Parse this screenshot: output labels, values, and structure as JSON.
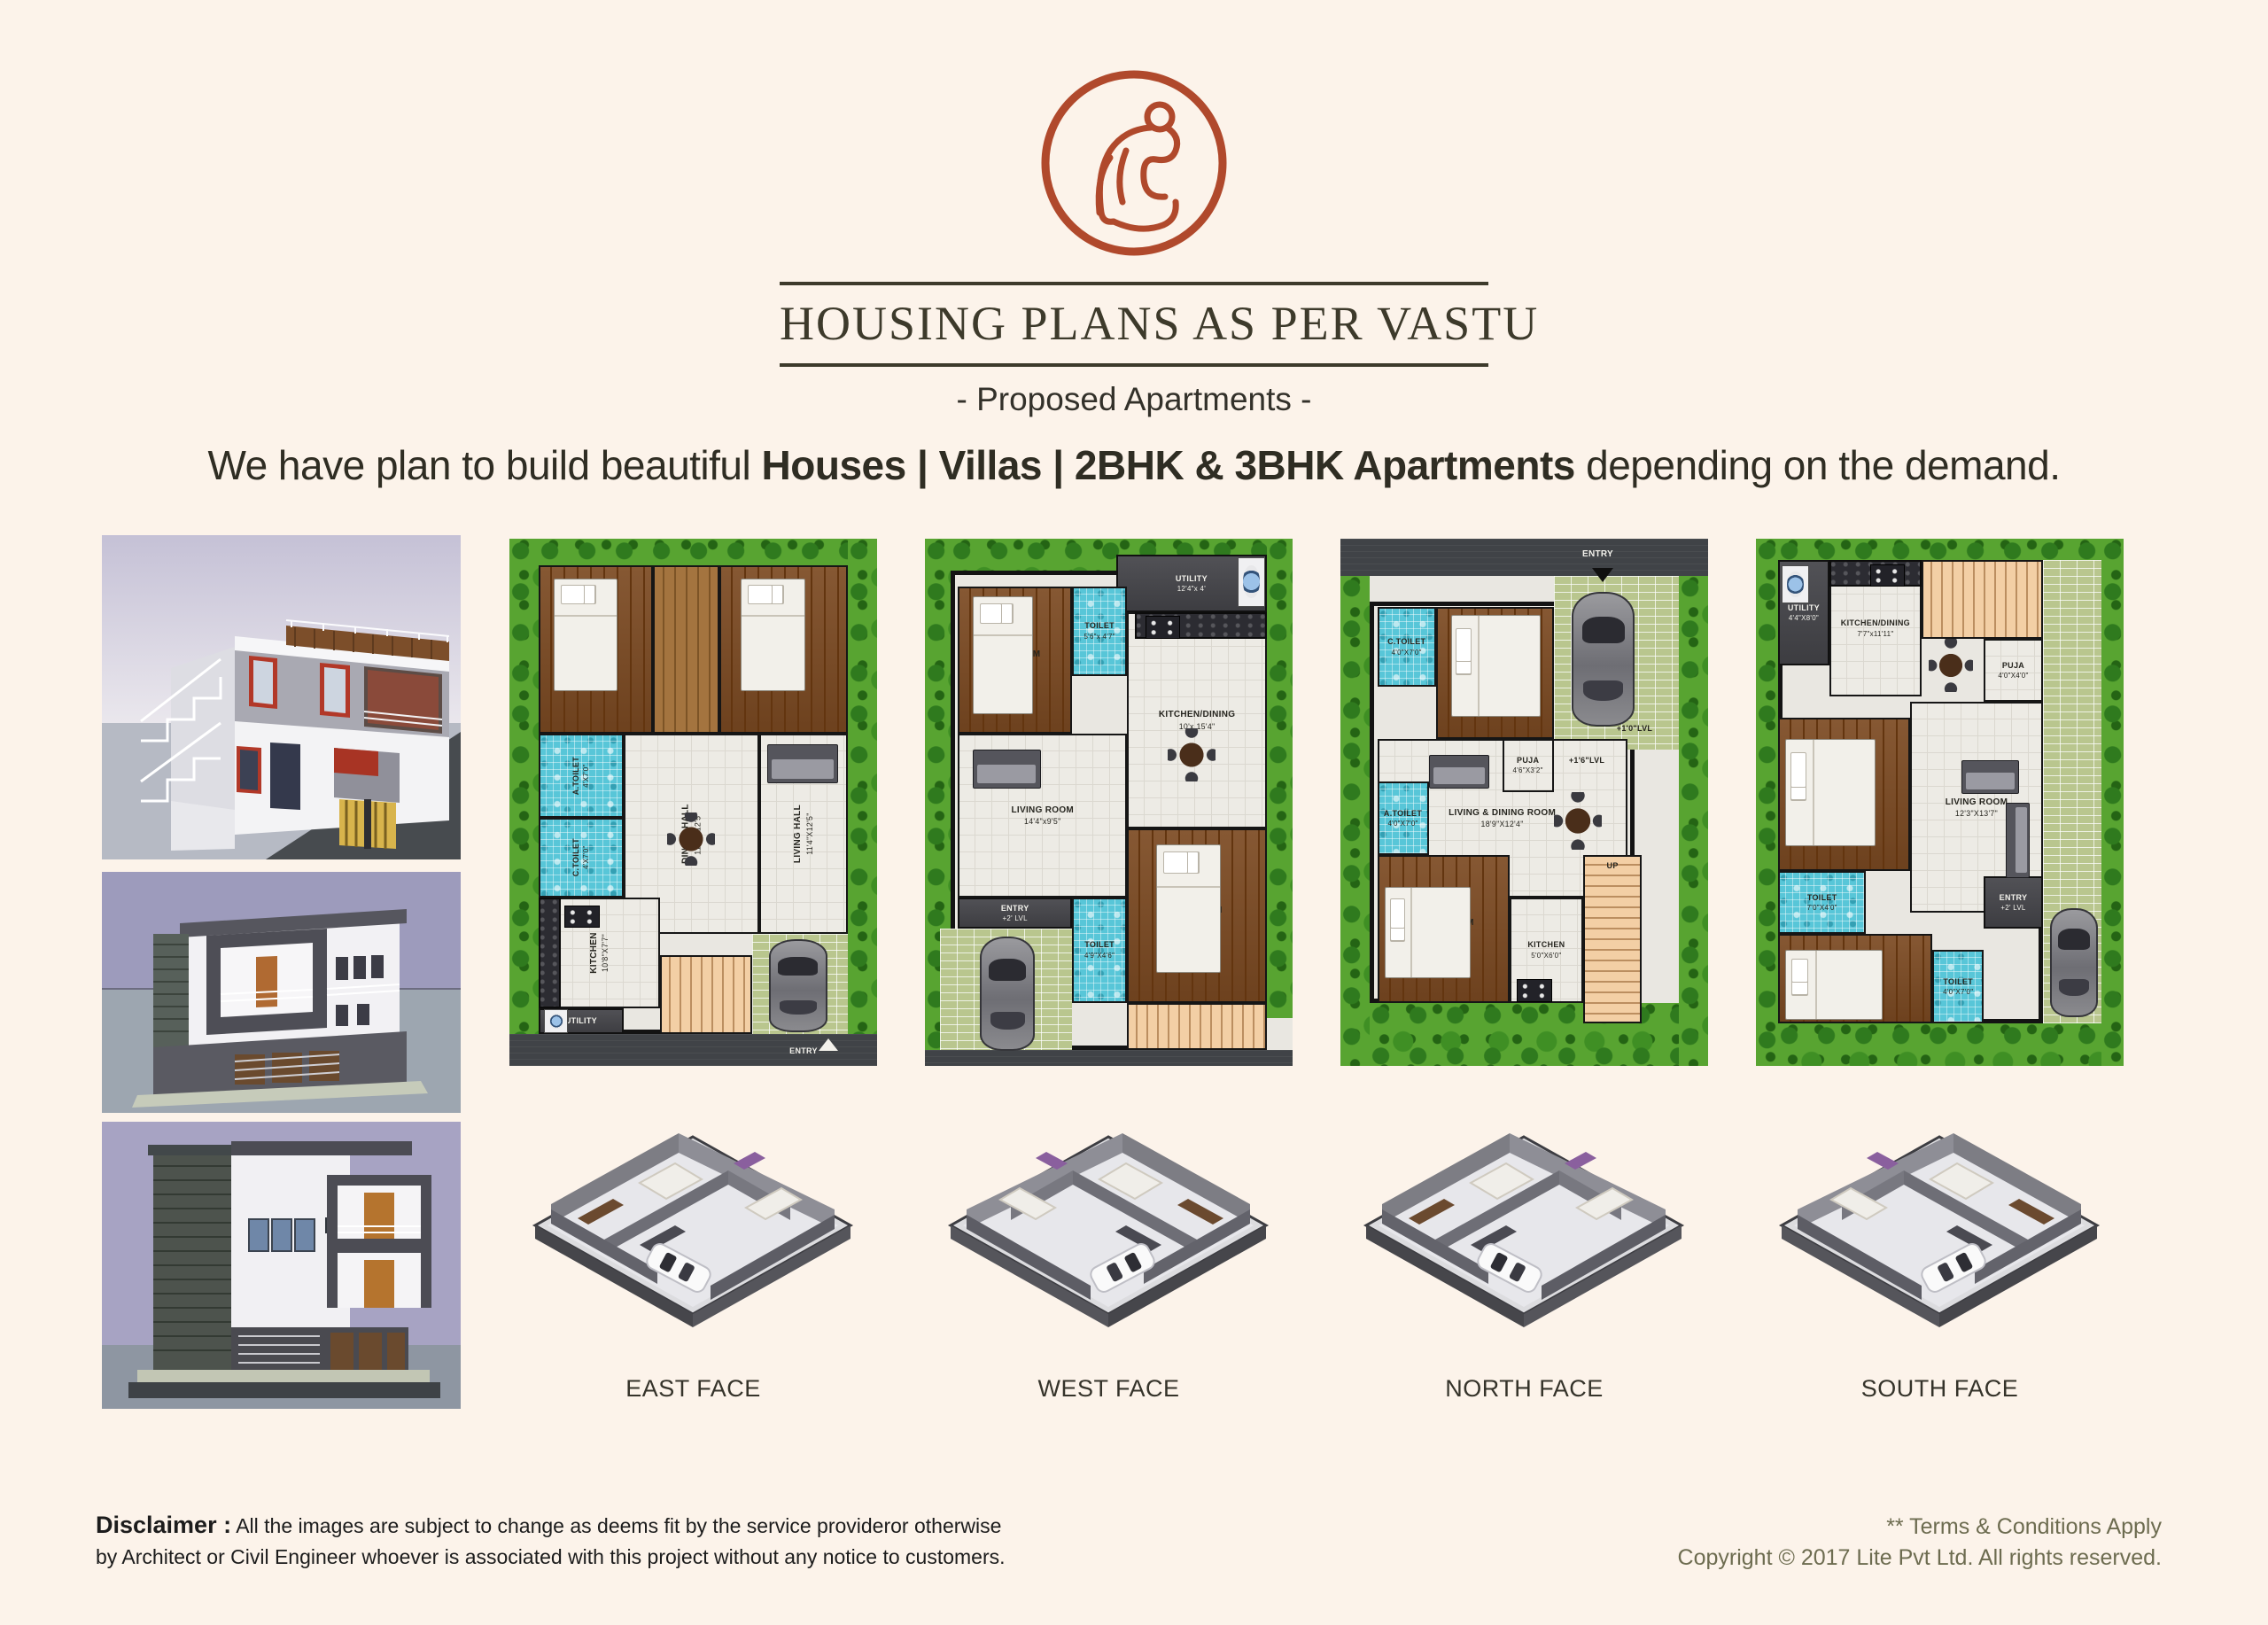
{
  "header": {
    "title": "HOUSING PLANS AS PER VASTU",
    "subtitle": "- Proposed Apartments -"
  },
  "headline": {
    "prefix": "We have plan to build beautiful ",
    "bold": "Houses | Villas | 2BHK & 3BHK Apartments",
    "suffix": " depending on the demand."
  },
  "colors": {
    "background": "#fcf3ea",
    "logo_rust": "#b0492c",
    "title_olive": "#3d3a2b",
    "footer_olive": "#6d6c50"
  },
  "plans": [
    {
      "face_label": "EAST FACE",
      "zones": [
        {
          "t": "garden",
          "x": 0,
          "y": 0,
          "w": 8,
          "h": 94
        },
        {
          "t": "garden",
          "x": 8,
          "y": 0,
          "w": 84,
          "h": 5
        },
        {
          "t": "garden",
          "x": 92,
          "y": 0,
          "w": 8,
          "h": 94
        },
        {
          "t": "floor",
          "x": 8,
          "y": 5,
          "w": 84,
          "h": 89
        },
        {
          "t": "wood",
          "x": 8,
          "y": 5,
          "w": 31,
          "h": 32,
          "l": "M.BEDROOM",
          "d": "11'X12'6\"",
          "r": 1
        },
        {
          "t": "woodl",
          "x": 39,
          "y": 5,
          "w": 18,
          "h": 32
        },
        {
          "t": "wood",
          "x": 57,
          "y": 5,
          "w": 35,
          "h": 32,
          "l": "BEDROOM",
          "d": "11'X12'0\"",
          "r": 1
        },
        {
          "t": "toilet",
          "x": 8,
          "y": 37,
          "w": 23,
          "h": 16,
          "l": "A.TOILET",
          "d": "4'X7'0\"",
          "r": 1,
          "fs": 9
        },
        {
          "t": "toilet",
          "x": 8,
          "y": 53,
          "w": 23,
          "h": 15,
          "l": "C.TOILET",
          "d": "4'X7'0\"",
          "r": 1,
          "fs": 9
        },
        {
          "t": "tile",
          "x": 31,
          "y": 37,
          "w": 37,
          "h": 38,
          "l": "DINING HALL",
          "d": "11'4\"X12'5\"",
          "r": 1
        },
        {
          "t": "tile",
          "x": 68,
          "y": 37,
          "w": 24,
          "h": 38,
          "l": "LIVING HALL",
          "d": "11'4\"X12'5\"",
          "r": 1
        },
        {
          "t": "tile",
          "x": 8,
          "y": 68,
          "w": 33,
          "h": 21,
          "l": "KITCHEN",
          "d": "10'8\"X7'7\"",
          "r": 1
        },
        {
          "t": "counter",
          "x": 8,
          "y": 68,
          "w": 6,
          "h": 21
        },
        {
          "t": "dark",
          "x": 8,
          "y": 89,
          "w": 23,
          "h": 5,
          "l": "UTILITY",
          "lt": 1,
          "fs": 9
        },
        {
          "t": "stairs-h",
          "x": 41,
          "y": 79,
          "w": 25,
          "h": 15
        },
        {
          "t": "paver",
          "x": 66,
          "y": 75,
          "w": 26,
          "h": 19
        },
        {
          "t": "road",
          "x": 0,
          "y": 94,
          "w": 100,
          "h": 6
        },
        {
          "t": "txt",
          "x": 72,
          "y": 94.6,
          "w": 16,
          "h": 5,
          "l": "ENTRY",
          "lt": 1,
          "fs": 9
        }
      ],
      "icons": [
        {
          "k": "bed-v",
          "x": 12,
          "y": 7.5,
          "w": 17,
          "h": 21
        },
        {
          "k": "bed-v",
          "x": 63,
          "y": 7.5,
          "w": 17,
          "h": 21
        },
        {
          "k": "table",
          "x": 43,
          "y": 52,
          "w": 13,
          "h": 10
        },
        {
          "k": "sofa-h",
          "x": 70,
          "y": 39,
          "w": 19,
          "h": 7
        },
        {
          "k": "stove",
          "x": 15,
          "y": 69.5,
          "w": 9,
          "h": 4
        },
        {
          "k": "wm",
          "x": 9.5,
          "y": 89.3,
          "w": 6,
          "h": 4.2
        },
        {
          "k": "car-v",
          "x": 70.5,
          "y": 76,
          "w": 15,
          "h": 17
        },
        {
          "k": "arrow-up",
          "x": 84,
          "y": 94.8,
          "w": 3,
          "h": 3
        }
      ]
    },
    {
      "face_label": "WEST FACE",
      "zones": [
        {
          "t": "garden",
          "x": 0,
          "y": 0,
          "w": 7,
          "h": 97
        },
        {
          "t": "garden",
          "x": 7,
          "y": 0,
          "w": 93,
          "h": 6
        },
        {
          "t": "garden",
          "x": 93,
          "y": 0,
          "w": 7,
          "h": 91
        },
        {
          "t": "floor",
          "x": 7,
          "y": 6,
          "w": 86,
          "h": 91
        },
        {
          "t": "dark",
          "x": 52,
          "y": 3,
          "w": 41,
          "h": 11,
          "l": "UTILITY",
          "d": "12'4\"x 4'",
          "lt": 1,
          "fs": 9
        },
        {
          "t": "wood",
          "x": 9,
          "y": 9,
          "w": 31,
          "h": 28,
          "l": "BED ROOM",
          "d": "12'4\"x 10'"
        },
        {
          "t": "toilet",
          "x": 40,
          "y": 9,
          "w": 15,
          "h": 17,
          "l": "TOILET",
          "d": "5'6\"x 4'7\"",
          "fs": 9
        },
        {
          "t": "tile",
          "x": 55,
          "y": 14,
          "w": 38,
          "h": 41,
          "l": "KITCHEN/DINING",
          "d": "10'x 15'4\""
        },
        {
          "t": "counter",
          "x": 57,
          "y": 14,
          "w": 36,
          "h": 5
        },
        {
          "t": "tile",
          "x": 9,
          "y": 37,
          "w": 46,
          "h": 31,
          "l": "LIVING ROOM",
          "d": "14'4\"x9'5\""
        },
        {
          "t": "dark",
          "x": 9,
          "y": 68,
          "w": 31,
          "h": 6,
          "l": "ENTRY",
          "d": "+2' LVL",
          "lt": 1,
          "fs": 9
        },
        {
          "t": "paver",
          "x": 4,
          "y": 74,
          "w": 36,
          "h": 23
        },
        {
          "t": "toilet",
          "x": 40,
          "y": 68,
          "w": 15,
          "h": 20,
          "l": "TOILET",
          "d": "4'9\"X4'6\"",
          "fs": 9
        },
        {
          "t": "wood",
          "x": 55,
          "y": 55,
          "w": 38,
          "h": 33,
          "l": "BED ROOM",
          "d": "12'4\"x 10'"
        },
        {
          "t": "stairs-h",
          "x": 55,
          "y": 88,
          "w": 38,
          "h": 9
        },
        {
          "t": "road",
          "x": 0,
          "y": 97,
          "w": 100,
          "h": 3
        }
      ],
      "icons": [
        {
          "k": "wm",
          "x": 85,
          "y": 3.6,
          "w": 7,
          "h": 9
        },
        {
          "k": "stove",
          "x": 60,
          "y": 14.6,
          "w": 9,
          "h": 4
        },
        {
          "k": "table",
          "x": 66,
          "y": 36,
          "w": 13,
          "h": 10
        },
        {
          "k": "sofa-h",
          "x": 13,
          "y": 40,
          "w": 18,
          "h": 7
        },
        {
          "k": "bed-v",
          "x": 13,
          "y": 11,
          "w": 16,
          "h": 22
        },
        {
          "k": "bed-v",
          "x": 63,
          "y": 58,
          "w": 17,
          "h": 24
        },
        {
          "k": "car-v",
          "x": 15,
          "y": 75.5,
          "w": 14,
          "h": 21
        }
      ]
    },
    {
      "face_label": "NORTH FACE",
      "zones": [
        {
          "t": "road",
          "x": 0,
          "y": 0,
          "w": 100,
          "h": 7
        },
        {
          "t": "garden",
          "x": 0,
          "y": 7,
          "w": 8,
          "h": 93
        },
        {
          "t": "garden",
          "x": 92,
          "y": 7,
          "w": 8,
          "h": 93
        },
        {
          "t": "garden",
          "x": 8,
          "y": 88,
          "w": 84,
          "h": 12
        },
        {
          "t": "floor",
          "x": 8,
          "y": 12,
          "w": 72,
          "h": 76
        },
        {
          "t": "paver",
          "x": 58,
          "y": 7,
          "w": 34,
          "h": 33
        },
        {
          "t": "toilet",
          "x": 10,
          "y": 13,
          "w": 16,
          "h": 15,
          "l": "C.TOILET",
          "d": "4'0\"X7'0\"",
          "fs": 9
        },
        {
          "t": "wood",
          "x": 26,
          "y": 13,
          "w": 32,
          "h": 25,
          "l": "BED ROOM",
          "d": "12'8\"X10'4\""
        },
        {
          "t": "tile",
          "x": 10,
          "y": 38,
          "w": 68,
          "h": 30,
          "l": "LIVING & DINING ROOM",
          "d": "18'9\"X12'4\""
        },
        {
          "t": "tile",
          "x": 44,
          "y": 38,
          "w": 14,
          "h": 10,
          "l": "PUJA",
          "d": "4'6\"X3'2\"",
          "fs": 9
        },
        {
          "t": "toilet",
          "x": 10,
          "y": 46,
          "w": 14,
          "h": 14,
          "l": "A.TOILET",
          "d": "4'0\"X7'0\"",
          "fs": 9
        },
        {
          "t": "wood",
          "x": 10,
          "y": 60,
          "w": 36,
          "h": 28,
          "l": "M.BED ROOM",
          "d": "12'0\"X11'4\""
        },
        {
          "t": "tile",
          "x": 46,
          "y": 68,
          "w": 20,
          "h": 20,
          "l": "KITCHEN",
          "d": "5'0\"X6'0\"",
          "fs": 9
        },
        {
          "t": "stairs-v",
          "x": 66,
          "y": 60,
          "w": 16,
          "h": 32
        },
        {
          "t": "txt",
          "x": 66,
          "y": 59,
          "w": 16,
          "h": 6,
          "l": "UP",
          "fs": 9
        },
        {
          "t": "txt",
          "x": 70,
          "y": 34,
          "w": 20,
          "h": 4,
          "l": "+1'0\"LVL",
          "fs": 9
        },
        {
          "t": "txt",
          "x": 58,
          "y": 40,
          "w": 18,
          "h": 4,
          "l": "+1'6\"LVL",
          "fs": 9
        },
        {
          "t": "txt",
          "x": 62,
          "y": 1,
          "w": 16,
          "h": 4,
          "l": "ENTRY",
          "lt": 1
        }
      ],
      "icons": [
        {
          "k": "arrow-down",
          "x": 68.5,
          "y": 5.5,
          "w": 3,
          "h": 3
        },
        {
          "k": "car-v",
          "x": 63,
          "y": 10,
          "w": 16,
          "h": 25
        },
        {
          "k": "bed-h",
          "x": 30,
          "y": 14.5,
          "w": 24,
          "h": 19
        },
        {
          "k": "bed-h",
          "x": 12,
          "y": 66,
          "w": 23,
          "h": 17
        },
        {
          "k": "table",
          "x": 58,
          "y": 48,
          "w": 13,
          "h": 11
        },
        {
          "k": "sofa-h",
          "x": 24,
          "y": 41,
          "w": 16,
          "h": 6
        },
        {
          "k": "stove",
          "x": 48,
          "y": 83.5,
          "w": 9,
          "h": 4
        }
      ]
    },
    {
      "face_label": "SOUTH FACE",
      "zones": [
        {
          "t": "garden",
          "x": 0,
          "y": 0,
          "w": 6,
          "h": 100
        },
        {
          "t": "garden",
          "x": 6,
          "y": 0,
          "w": 88,
          "h": 4
        },
        {
          "t": "garden",
          "x": 94,
          "y": 0,
          "w": 6,
          "h": 100
        },
        {
          "t": "garden",
          "x": 6,
          "y": 92,
          "w": 88,
          "h": 8
        },
        {
          "t": "paver",
          "x": 78,
          "y": 4,
          "w": 16,
          "h": 88
        },
        {
          "t": "floor",
          "x": 6,
          "y": 4,
          "w": 72,
          "h": 88
        },
        {
          "t": "dark",
          "x": 6,
          "y": 4,
          "w": 14,
          "h": 20,
          "l": "UTILITY",
          "d": "4'4\"X8'0\"",
          "lt": 1,
          "fs": 9
        },
        {
          "t": "tile",
          "x": 20,
          "y": 4,
          "w": 25,
          "h": 26,
          "l": "KITCHEN/DINING",
          "d": "7'7\"x11'11\"",
          "fs": 9
        },
        {
          "t": "counter",
          "x": 20,
          "y": 4,
          "w": 25,
          "h": 5
        },
        {
          "t": "stairs-h",
          "x": 45,
          "y": 4,
          "w": 33,
          "h": 15
        },
        {
          "t": "tile",
          "x": 62,
          "y": 19,
          "w": 16,
          "h": 12,
          "l": "PUJA",
          "d": "4'0\"X4'0\"",
          "fs": 9
        },
        {
          "t": "tile",
          "x": 42,
          "y": 31,
          "w": 36,
          "h": 40,
          "l": "LIVING ROOM",
          "d": "12'3\"X13'7\""
        },
        {
          "t": "wood",
          "x": 6,
          "y": 34,
          "w": 36,
          "h": 29,
          "l": "BED ROOM",
          "d": "10'8\"X9'4\""
        },
        {
          "t": "toilet",
          "x": 6,
          "y": 63,
          "w": 24,
          "h": 12,
          "l": "TOILET",
          "d": "7'0\"X4'0\"",
          "fs": 9
        },
        {
          "t": "wood",
          "x": 6,
          "y": 75,
          "w": 42,
          "h": 17,
          "l": "BED ROOM",
          "d": "13'4\"X11'0\""
        },
        {
          "t": "toilet",
          "x": 48,
          "y": 78,
          "w": 14,
          "h": 14,
          "l": "TOILET",
          "d": "4'0\"X7'0\"",
          "fs": 9
        },
        {
          "t": "dark",
          "x": 62,
          "y": 64,
          "w": 16,
          "h": 10,
          "l": "ENTRY",
          "d": "+2' LVL",
          "lt": 1,
          "fs": 9
        }
      ],
      "icons": [
        {
          "k": "wm",
          "x": 7,
          "y": 5,
          "w": 7,
          "h": 7
        },
        {
          "k": "stove",
          "x": 31,
          "y": 4.8,
          "w": 9,
          "h": 4
        },
        {
          "k": "table",
          "x": 47,
          "y": 19,
          "w": 12,
          "h": 10
        },
        {
          "k": "sofa-h",
          "x": 56,
          "y": 42,
          "w": 15,
          "h": 6
        },
        {
          "k": "sofa-v",
          "x": 68,
          "y": 50,
          "w": 6,
          "h": 14
        },
        {
          "k": "bed-h",
          "x": 8,
          "y": 38,
          "w": 24,
          "h": 20
        },
        {
          "k": "bed-h",
          "x": 8,
          "y": 78,
          "w": 26,
          "h": 13
        },
        {
          "k": "car-v",
          "x": 80,
          "y": 70,
          "w": 12,
          "h": 20
        }
      ]
    }
  ],
  "footer": {
    "disclaimer_label": "Disclaimer :",
    "disclaimer_line1": " All the images are subject to change as deems fit by the service provideror otherwise",
    "disclaimer_line2": "by Architect or Civil Engineer whoever is associated with this project without any notice to customers.",
    "terms": "** Terms & Conditions Apply",
    "copyright": "Copyright © 2017 Lite Pvt Ltd. All rights reserved."
  }
}
